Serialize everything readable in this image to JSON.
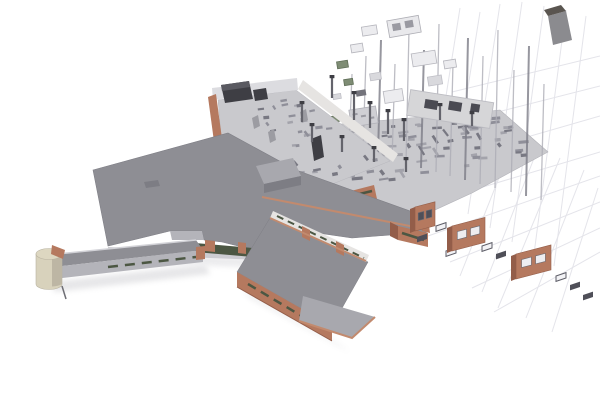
{
  "meta": {
    "title": "Architectural BIM model visualization",
    "description": "3D axonometric rendering of a cross-shaped building: completed wing with gray roofs and brick walls on the left, exploding into floor plate, columns, floating wall panels and brick facade panels over a faint construction grid on the right"
  },
  "palette": {
    "background": "#ffffff",
    "roof_gray": "#8e8e94",
    "roof_gray_light": "#a8a8ae",
    "roof_gray_dark": "#7d7d84",
    "floor_light": "#c9c9cd",
    "wall_white": "#e6e4e2",
    "wall_light": "#dcdce0",
    "wall_mid": "#b4b4ba",
    "brick": "#b5795f",
    "brick_light": "#c28a6e",
    "brick_dark": "#935d49",
    "glazing_green": "#4c5743",
    "green_panel": "#7e8c74",
    "cream": "#d8d2bc",
    "dark_box": "#3e3e44",
    "dark_slot": "#4f4f58",
    "column_gray": "#adadb6",
    "column_dark": "#7e7e88",
    "grid_line": "#e4e4ea"
  },
  "decor": {
    "grid_lines": [
      [
        500,
        4,
        468,
        214
      ],
      [
        522,
        2,
        490,
        228
      ],
      [
        544,
        6,
        512,
        242
      ],
      [
        566,
        10,
        534,
        254
      ],
      [
        586,
        16,
        554,
        266
      ],
      [
        480,
        12,
        450,
        200
      ],
      [
        460,
        8,
        432,
        184
      ],
      [
        560,
        158,
        498,
        308
      ],
      [
        584,
        170,
        526,
        318
      ],
      [
        538,
        148,
        482,
        292
      ],
      [
        514,
        140,
        460,
        276
      ],
      [
        598,
        188,
        552,
        332
      ],
      [
        406,
        210,
        600,
        152
      ],
      [
        428,
        236,
        600,
        176
      ],
      [
        450,
        262,
        600,
        202
      ],
      [
        472,
        288,
        600,
        228
      ],
      [
        494,
        312,
        600,
        252
      ],
      [
        452,
        92,
        600,
        56
      ],
      [
        466,
        120,
        600,
        86
      ],
      [
        482,
        150,
        600,
        116
      ]
    ],
    "columns": [
      [
        352,
        74,
        148,
        -3,
        0
      ],
      [
        366,
        56,
        152,
        -3,
        0
      ],
      [
        381,
        40,
        156,
        -3,
        1
      ],
      [
        395,
        64,
        160,
        -3,
        0
      ],
      [
        409,
        30,
        164,
        -3,
        0
      ],
      [
        424,
        50,
        168,
        -3,
        1
      ],
      [
        439,
        24,
        172,
        -3,
        0
      ],
      [
        453,
        64,
        176,
        -3,
        0
      ],
      [
        468,
        38,
        180,
        -3,
        1
      ],
      [
        483,
        56,
        184,
        -3,
        0
      ],
      [
        498,
        30,
        188,
        -3,
        0
      ],
      [
        514,
        70,
        192,
        -3,
        0
      ],
      [
        529,
        46,
        196,
        -3,
        1
      ],
      [
        544,
        84,
        200,
        -3,
        0
      ]
    ],
    "panels": [
      [
        337,
        61,
        11,
        7,
        -9,
        "green"
      ],
      [
        351,
        44,
        12,
        8,
        -9,
        "outline"
      ],
      [
        362,
        26,
        15,
        9,
        -9,
        "outline"
      ],
      [
        388,
        18,
        32,
        17,
        -10,
        "outline2"
      ],
      [
        412,
        52,
        24,
        13,
        -9,
        "outline"
      ],
      [
        344,
        79,
        9,
        6,
        -9,
        "green"
      ],
      [
        333,
        94,
        8,
        5,
        -9,
        "light"
      ],
      [
        356,
        90,
        10,
        6,
        -9,
        "dark"
      ],
      [
        370,
        73,
        11,
        7,
        -9,
        "light"
      ],
      [
        330,
        116,
        9,
        6,
        -9,
        "green"
      ],
      [
        350,
        108,
        27,
        17,
        -9,
        "speck"
      ],
      [
        384,
        90,
        19,
        12,
        -9,
        "outline"
      ],
      [
        428,
        76,
        14,
        9,
        -9,
        "light"
      ],
      [
        444,
        60,
        12,
        8,
        -9,
        "outline"
      ]
    ],
    "speckle_colors": [
      "#8f8f99",
      "#a3a3ab",
      "#787882"
    ],
    "speckle_areas": [
      {
        "target": "g-speckles",
        "quad": [
          [
            300,
            132
          ],
          [
            494,
            114
          ],
          [
            542,
            152
          ],
          [
            338,
            190
          ]
        ],
        "count": 85,
        "minLen": 4,
        "maxLen": 11,
        "angle": -6
      },
      {
        "target": "g-court-speckles",
        "quad": [
          [
            226,
            104
          ],
          [
            292,
            95
          ],
          [
            380,
            160
          ],
          [
            312,
            186
          ]
        ],
        "count": 30,
        "minLen": 3,
        "maxLen": 8,
        "angle": -8
      }
    ],
    "plate_columns": [
      [
        312,
        142,
        16
      ],
      [
        342,
        152,
        14
      ],
      [
        374,
        162,
        13
      ],
      [
        406,
        172,
        12
      ],
      [
        302,
        122,
        18
      ],
      [
        354,
        120,
        26
      ],
      [
        370,
        128,
        24
      ],
      [
        388,
        134,
        22
      ],
      [
        404,
        141,
        20
      ],
      [
        440,
        120,
        14
      ],
      [
        472,
        126,
        12
      ],
      [
        332,
        98,
        20
      ]
    ],
    "window_frames": [
      [
        436,
        226,
        0
      ],
      [
        457,
        240,
        1
      ],
      [
        482,
        246,
        0
      ],
      [
        496,
        254,
        1
      ],
      [
        520,
        261,
        0
      ],
      [
        531,
        268,
        1
      ],
      [
        556,
        276,
        0
      ],
      [
        570,
        285,
        1
      ],
      [
        417,
        237,
        1
      ],
      [
        446,
        251,
        0
      ],
      [
        583,
        295,
        1
      ]
    ],
    "brick_panels": [
      {
        "x": 415,
        "y": 207,
        "w": 20,
        "h": 24,
        "dark": 1
      },
      {
        "x": 452,
        "y": 226,
        "w": 33,
        "h": 25,
        "dark": 0
      },
      {
        "x": 516,
        "y": 254,
        "w": 35,
        "h": 25,
        "dark": 0
      }
    ]
  }
}
